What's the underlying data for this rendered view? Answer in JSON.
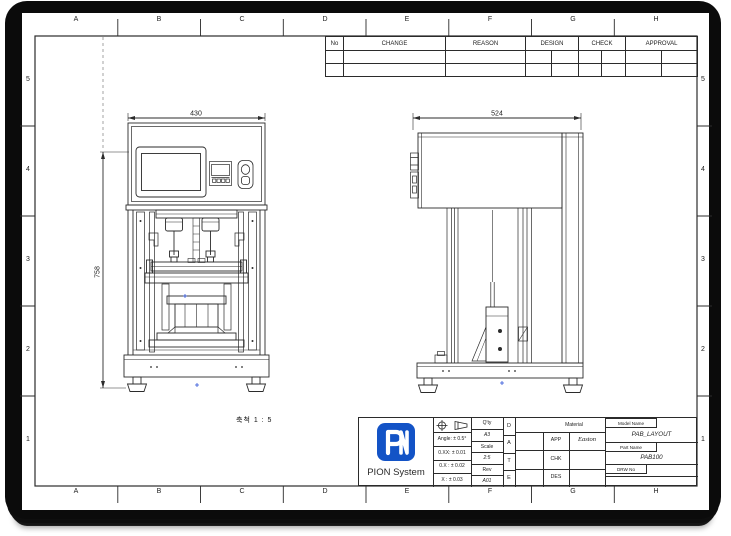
{
  "grid": {
    "cols": [
      "A",
      "B",
      "C",
      "D",
      "E",
      "F",
      "G",
      "H"
    ],
    "rows": [
      "5",
      "4",
      "3",
      "2",
      "1"
    ]
  },
  "revision_table": {
    "no": "No",
    "change": "CHANGE",
    "reason": "REASON",
    "design": "DESIGN",
    "check": "CHECK",
    "approval": "APPROVAL"
  },
  "views": {
    "front": {
      "width_dim": "430",
      "height_dim": "758",
      "scale_note": "축척  1 : 5"
    },
    "side": {
      "width_dim": "524"
    }
  },
  "title_block": {
    "company": "PION System",
    "tolerance_angle": "Angle: ± 0.5°",
    "tolerance_xx": "0.XX: ± 0.01",
    "tolerance_x": "0.X : ± 0.02",
    "tolerance_int": "X : ± 0.03",
    "qty_label": "Q'ty",
    "paper_size": "A3",
    "scale_label": "Scale",
    "scale_value": "2:5",
    "rev_label": "Rev",
    "rev_value": "A01",
    "date_d": "D",
    "date_a": "A",
    "date_t": "T",
    "date_e": "E",
    "material_label": "Material",
    "app_label": "APP",
    "app_sign": "Easton",
    "chk_label": "CHK",
    "chk_sign": "",
    "des_label": "DES",
    "des_sign": "",
    "model_name_label": "Model Name",
    "model_name_value": "PAB_LAYOUT",
    "part_name_label": "Part Name",
    "part_name_value": "PAB100",
    "drw_no_label": "DRW No",
    "drw_no_value": ""
  },
  "colors": {
    "line": "#2b2b2b",
    "logo_blue": "#1353c6",
    "center_mark_blue": "#2b50d8"
  }
}
